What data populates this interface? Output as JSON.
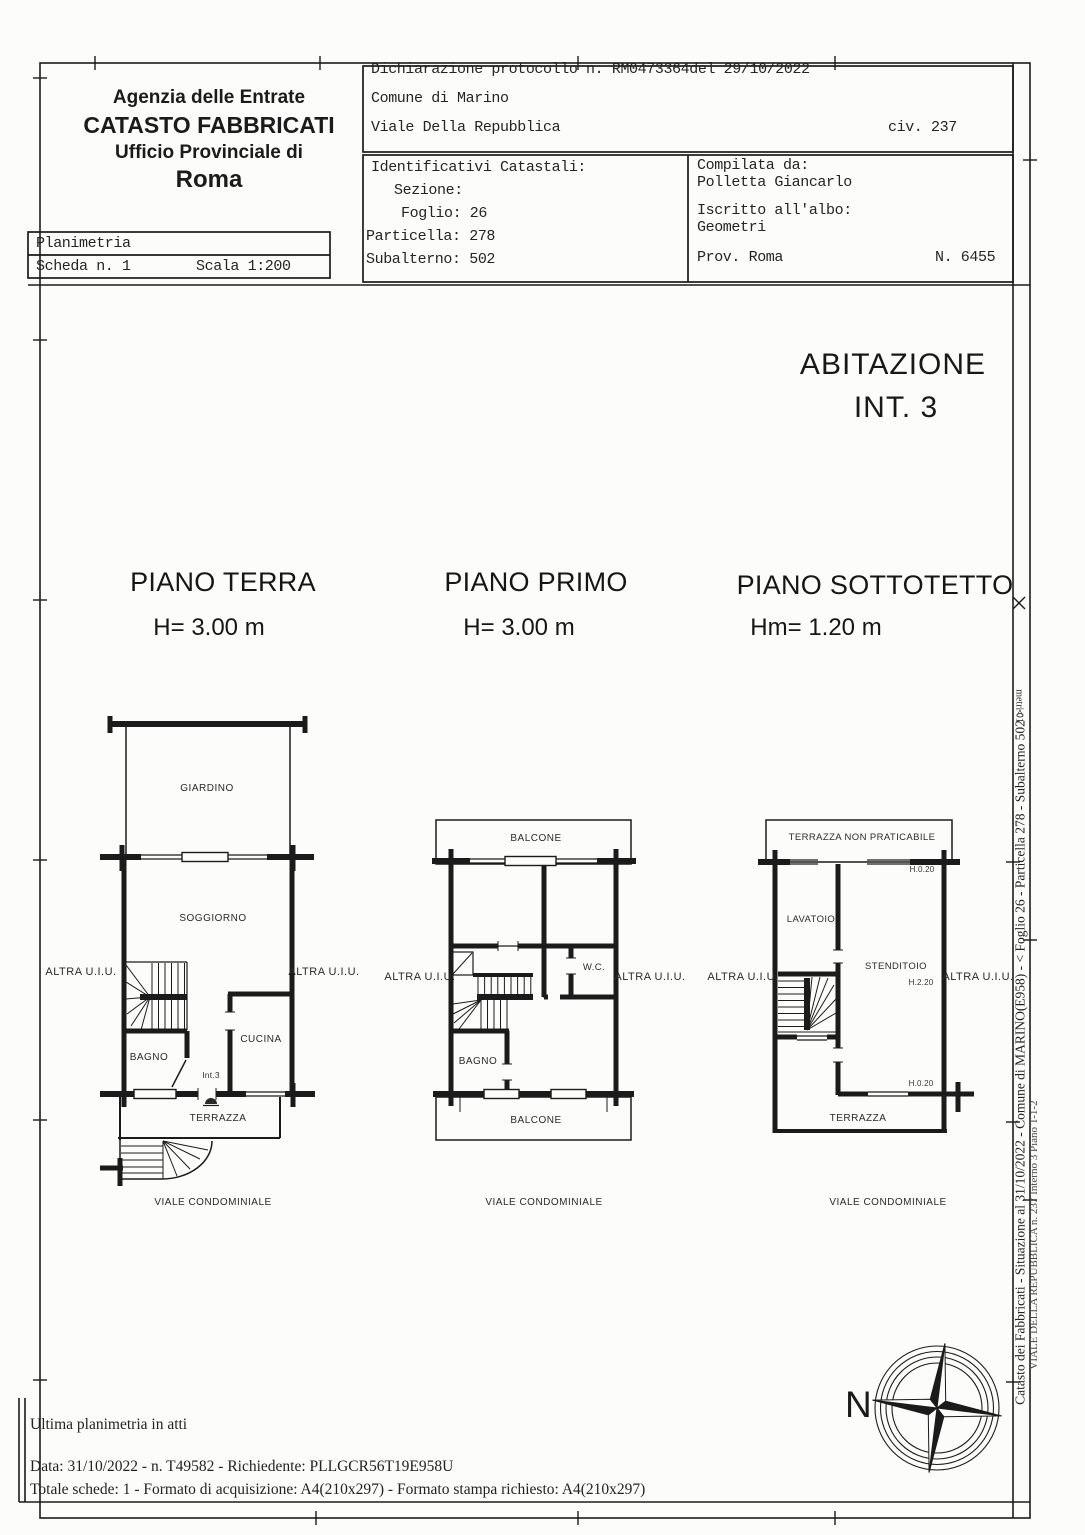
{
  "doc": {
    "header_left": {
      "line1": "Agenzia delle Entrate",
      "line2": "CATASTO FABBRICATI",
      "line3": "Ufficio Provinciale di",
      "line4": "Roma"
    },
    "planimetria": {
      "title": "Planimetria",
      "scheda": "Scheda n. 1",
      "scala": "Scala 1:200"
    },
    "protocol": {
      "dichiarazione": "Dichiarazione protocollo n. RM0473364del  29/10/2022",
      "comune": "Comune di Marino",
      "indirizzo": "Viale Della Repubblica",
      "civico": "civ. 237"
    },
    "identificativi": {
      "title": "Identificativi Catastali:",
      "sezione": "Sezione:",
      "foglio": "Foglio: 26",
      "particella": "Particella: 278",
      "subalterno": "Subalterno: 502"
    },
    "compilata": {
      "title": "Compilata da:",
      "nome": "Polletta Giancarlo",
      "iscritto": "Iscritto all'albo:",
      "albo": "Geometri",
      "prov": "Prov. Roma",
      "numero": "N. 6455"
    }
  },
  "unit": {
    "line1": "ABITAZIONE",
    "line2": "INT. 3"
  },
  "floors": [
    {
      "title": "PIANO TERRA",
      "height": "H= 3.00 m",
      "labels": {
        "giardino": "GIARDINO",
        "soggiorno": "SOGGIORNO",
        "bagno": "BAGNO",
        "cucina": "CUCINA",
        "unit": "Int.3",
        "terrazza": "TERRAZZA",
        "street": "VIALE CONDOMINIALE",
        "left": "ALTRA U.I.U.",
        "right": "ALTRA U.I.U."
      }
    },
    {
      "title": "PIANO PRIMO",
      "height": "H= 3.00 m",
      "labels": {
        "balcone_top": "BALCONE",
        "wc": "W.C.",
        "bagno": "BAGNO",
        "balcone_bottom": "BALCONE",
        "street": "VIALE CONDOMINIALE",
        "left": "ALTRA U.I.U.",
        "right": "ALTRA U.I.U."
      }
    },
    {
      "title": "PIANO SOTTOTETTO",
      "height": "Hm= 1.20 m",
      "labels": {
        "terrazza_top": "TERRAZZA NON PRATICABILE",
        "lavatoio": "LAVATOIO",
        "stenditoio": "STENDITOIO",
        "h_top": "H.0.20",
        "h_mid": "H.2.20",
        "h_bottom": "H.0.20",
        "terrazza_bottom": "TERRAZZA",
        "street": "VIALE CONDOMINIALE",
        "left": "ALTRA U.I.U.",
        "right": "ALTRA U.I.U."
      }
    }
  ],
  "compass": {
    "north": "N"
  },
  "side": {
    "main": "Catasto dei Fabbricati - Situazione al 31/10/2022 - Comune di MARINO(E958) - < Foglio 26 - Particella 278 - Subalterno 502 >",
    "secondary": "VIALE DELLA REPUBBLICA n. 237 Interno 3 Piano T-1-2",
    "ruler": "metri 01"
  },
  "footer": {
    "line1": "Ultima planimetria in atti",
    "line2": "Data: 31/10/2022 - n. T49582 - Richiedente: PLLGCR56T19E958U",
    "line3": "Totale schede: 1 - Formato di acquisizione: A4(210x297)  - Formato stampa richiesto: A4(210x297)"
  },
  "colors": {
    "ink": "#1b1b1b",
    "paper": "#fcfcfa"
  }
}
